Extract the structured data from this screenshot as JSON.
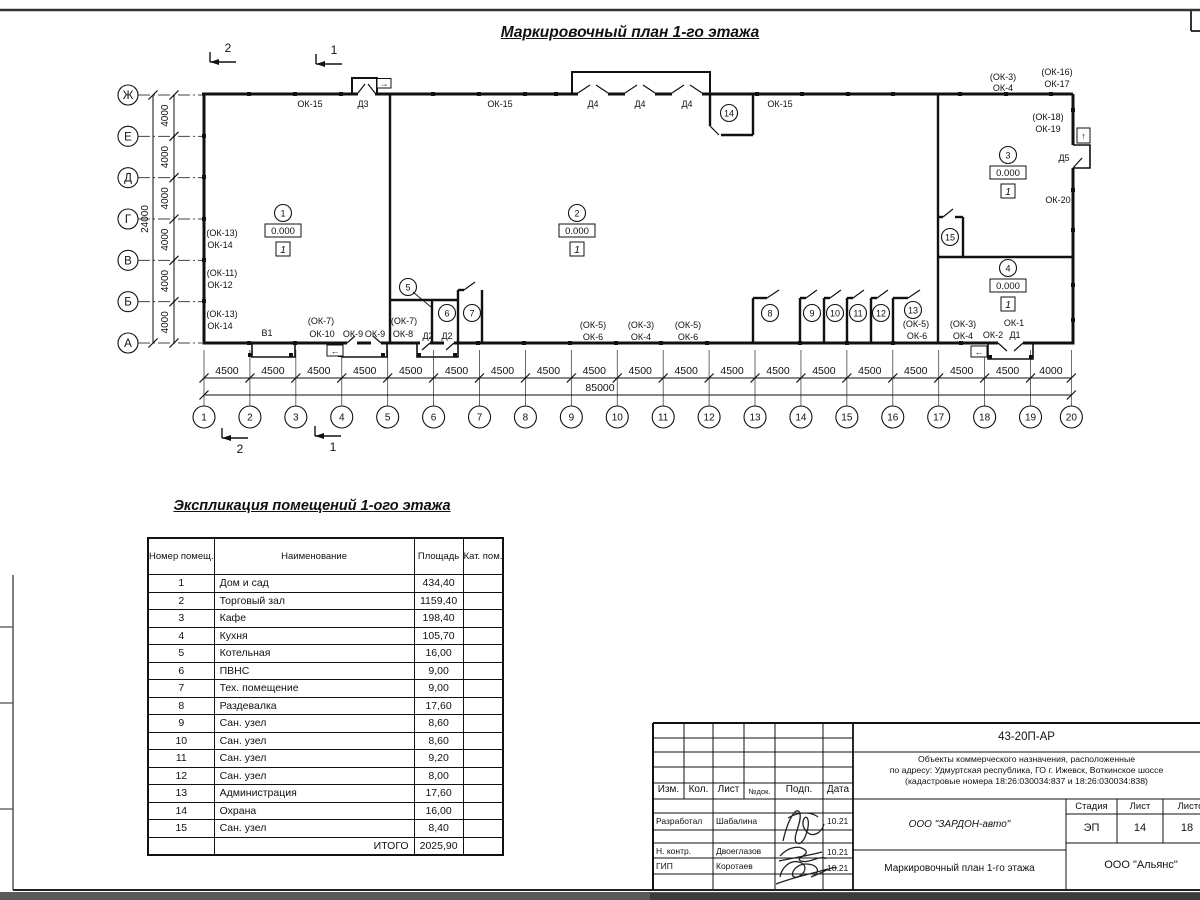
{
  "sheet": {
    "plan_title": "Маркировочный план 1-го этажа",
    "table_title": "Экспликация помещений 1-ого этажа"
  },
  "plan": {
    "axes_left": [
      "Ж",
      "Е",
      "Д",
      "Г",
      "В",
      "Б",
      "А"
    ],
    "axis_gap_dim": "4000",
    "axis_total_dim": "24000",
    "columns": [
      "1",
      "2",
      "3",
      "4",
      "5",
      "6",
      "7",
      "8",
      "9",
      "10",
      "11",
      "12",
      "13",
      "14",
      "15",
      "16",
      "17",
      "18",
      "19",
      "20"
    ],
    "column_gap_dims": [
      "4500",
      "4500",
      "4500",
      "4500",
      "4500",
      "4500",
      "4500",
      "4500",
      "4500",
      "4500",
      "4500",
      "4500",
      "4500",
      "4500",
      "4500",
      "4500",
      "4500",
      "4500",
      "4000"
    ],
    "column_total_dim": "85000",
    "section_marks": {
      "top_left": "2",
      "top_right": "1",
      "bottom_left": "2",
      "bottom_right": "1"
    },
    "room_markers": [
      {
        "num": "1",
        "elev": "0.000",
        "type": "1"
      },
      {
        "num": "2",
        "elev": "0.000",
        "type": "1"
      },
      {
        "num": "3",
        "elev": "0.000",
        "type": "1"
      },
      {
        "num": "4",
        "elev": "0.000",
        "type": "1"
      }
    ],
    "room_circles": [
      "5",
      "6",
      "7",
      "8",
      "9",
      "10",
      "11",
      "12",
      "13",
      "14",
      "15"
    ],
    "exit_arrows": {
      "top": "→",
      "bottom_left": "←",
      "bottom_right": "←",
      "right": "↑"
    },
    "wall_labels": [
      {
        "t": "ОК-15",
        "x": 310,
        "y": 107
      },
      {
        "t": "Д3",
        "x": 363,
        "y": 107
      },
      {
        "t": "ОК-15",
        "x": 500,
        "y": 107
      },
      {
        "t": "Д4",
        "x": 593,
        "y": 107
      },
      {
        "t": "Д4",
        "x": 640,
        "y": 107
      },
      {
        "t": "Д4",
        "x": 687,
        "y": 107
      },
      {
        "t": "ОК-15",
        "x": 780,
        "y": 107
      },
      {
        "t": "(ОК-3)",
        "x": 1003,
        "y": 80
      },
      {
        "t": "ОК-4",
        "x": 1003,
        "y": 91
      },
      {
        "t": "(ОК-16)",
        "x": 1057,
        "y": 75
      },
      {
        "t": "ОК-17",
        "x": 1057,
        "y": 87
      },
      {
        "t": "(ОК-18)",
        "x": 1048,
        "y": 120
      },
      {
        "t": "ОК-19",
        "x": 1048,
        "y": 132
      },
      {
        "t": "Д5",
        "x": 1064,
        "y": 161
      },
      {
        "t": "ОК-20",
        "x": 1058,
        "y": 203
      },
      {
        "t": "(ОК-13)",
        "x": 222,
        "y": 236
      },
      {
        "t": "ОК-14",
        "x": 220,
        "y": 248
      },
      {
        "t": "(ОК-11)",
        "x": 222,
        "y": 276
      },
      {
        "t": "ОК-12",
        "x": 220,
        "y": 288
      },
      {
        "t": "(ОК-13)",
        "x": 222,
        "y": 317
      },
      {
        "t": "ОК-14",
        "x": 220,
        "y": 329
      },
      {
        "t": "В1",
        "x": 267,
        "y": 336
      },
      {
        "t": "(ОК-7)",
        "x": 321,
        "y": 324
      },
      {
        "t": "ОК-10",
        "x": 322,
        "y": 337
      },
      {
        "t": "ОК-9",
        "x": 353,
        "y": 337
      },
      {
        "t": "ОК-9",
        "x": 375,
        "y": 337
      },
      {
        "t": "(ОК-7)",
        "x": 404,
        "y": 324
      },
      {
        "t": "ОК-8",
        "x": 403,
        "y": 337
      },
      {
        "t": "Д2",
        "x": 428,
        "y": 339
      },
      {
        "t": "Д2",
        "x": 447,
        "y": 339
      },
      {
        "t": "(ОК-5)",
        "x": 593,
        "y": 328
      },
      {
        "t": "ОК-6",
        "x": 593,
        "y": 340
      },
      {
        "t": "(ОК-3)",
        "x": 641,
        "y": 328
      },
      {
        "t": "ОК-4",
        "x": 641,
        "y": 340
      },
      {
        "t": "(ОК-5)",
        "x": 688,
        "y": 328
      },
      {
        "t": "ОК-6",
        "x": 688,
        "y": 340
      },
      {
        "t": "(ОК-5)",
        "x": 916,
        "y": 327
      },
      {
        "t": "ОК-6",
        "x": 917,
        "y": 339
      },
      {
        "t": "(ОК-3)",
        "x": 963,
        "y": 327
      },
      {
        "t": "ОК-4",
        "x": 963,
        "y": 339
      },
      {
        "t": "ОК-2",
        "x": 993,
        "y": 338
      },
      {
        "t": "ОК-1",
        "x": 1014,
        "y": 326
      },
      {
        "t": "Д1",
        "x": 1015,
        "y": 338
      }
    ]
  },
  "explication": {
    "headers": [
      "Номер помещ.",
      "Наименование",
      "Площадь",
      "Кат. пом."
    ],
    "rows": [
      [
        "1",
        "Дом и сад",
        "434,40"
      ],
      [
        "2",
        "Торговый зал",
        "1159,40"
      ],
      [
        "3",
        "Кафе",
        "198,40"
      ],
      [
        "4",
        "Кухня",
        "105,70"
      ],
      [
        "5",
        "Котельная",
        "16,00"
      ],
      [
        "6",
        "ПВНС",
        "9,00"
      ],
      [
        "7",
        "Тех. помещение",
        "9,00"
      ],
      [
        "8",
        "Раздевалка",
        "17,60"
      ],
      [
        "9",
        "Сан. узел",
        "8,60"
      ],
      [
        "10",
        "Сан. узел",
        "8,60"
      ],
      [
        "11",
        "Сан. узел",
        "9,20"
      ],
      [
        "12",
        "Сан. узел",
        "8,00"
      ],
      [
        "13",
        "Администрация",
        "17,60"
      ],
      [
        "14",
        "Охрана",
        "16,00"
      ],
      [
        "15",
        "Сан. узел",
        "8,40"
      ]
    ],
    "total_label": "ИТОГО",
    "total_value": "2025,90"
  },
  "stamp": {
    "doc_code": "43-20П-АР",
    "address_lines": [
      "Объекты коммерческого назначения, расположенные",
      "по адресу: Удмуртская республика, ГО г. Ижевск, Воткинское шоссе",
      "(кадастровые номера 18:26:030034:837 и 18:26:030034:838)"
    ],
    "header_cols": [
      "Изм.",
      "Кол.",
      "Лист",
      "№док.",
      "Подп.",
      "Дата"
    ],
    "rows": [
      {
        "role": "Разработал",
        "name": "Шабалина",
        "date": "10.21"
      },
      {
        "role": "Н. контр.",
        "name": "Двоеглазов",
        "date": "10.21"
      },
      {
        "role": "ГИП",
        "name": "Коротаев",
        "date": "10.21"
      }
    ],
    "org_developer": "ООО \"ЗАРДОН-авто\"",
    "stage_label": "Стадия",
    "sheet_label": "Лист",
    "sheets_label": "Листов",
    "stage": "ЭП",
    "sheet": "14",
    "sheets": "18",
    "doc_title": "Маркировочный план 1-го этажа",
    "org_customer": "ООО \"Альянс\""
  }
}
